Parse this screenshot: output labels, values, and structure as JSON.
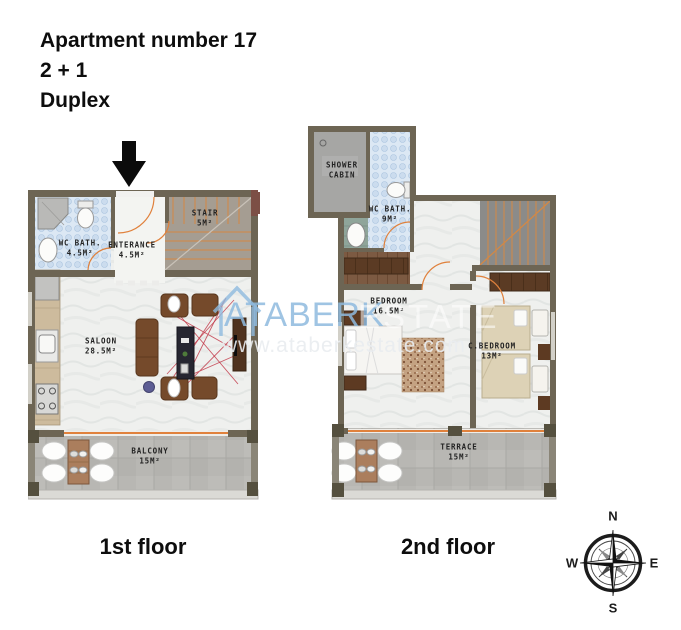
{
  "header": {
    "title": "Apartment number 17",
    "config": "2 + 1",
    "type": "Duplex"
  },
  "floor1": {
    "caption": "1st floor",
    "rooms": {
      "wc_bath": {
        "name": "WC BATH.",
        "area": "4.5M²"
      },
      "entrance": {
        "name": "ENTERANCE",
        "area": "4.5M²"
      },
      "stair": {
        "name": "STAIR",
        "area": "5M²"
      },
      "saloon": {
        "name": "SALOON",
        "area": "28.5M²"
      },
      "balcony": {
        "name": "BALCONY",
        "area": "15M²"
      }
    }
  },
  "floor2": {
    "caption": "2nd floor",
    "rooms": {
      "shower_cabin": {
        "name": "SHOWER CABIN"
      },
      "wc_bath": {
        "name": "WC BATH.",
        "area": "9M²"
      },
      "bedroom": {
        "name": "BEDROOM",
        "area": "16.5M²"
      },
      "c_bedroom": {
        "name": "C.BEDROOM",
        "area": "13M²"
      },
      "terrace": {
        "name": "TERRACE",
        "area": "15M²"
      }
    }
  },
  "compass": {
    "north": "N",
    "south": "S",
    "east": "E",
    "west": "W"
  },
  "watermark": {
    "brand": "ATABERK",
    "brand_suffix": "ESTATE",
    "website": "www.ataberkestate.com"
  },
  "colors": {
    "wall": "#6d6554",
    "accent_orange": "#e0813c",
    "tile_blue": "#dce8f4",
    "watermark_blue": "#8ebade"
  }
}
